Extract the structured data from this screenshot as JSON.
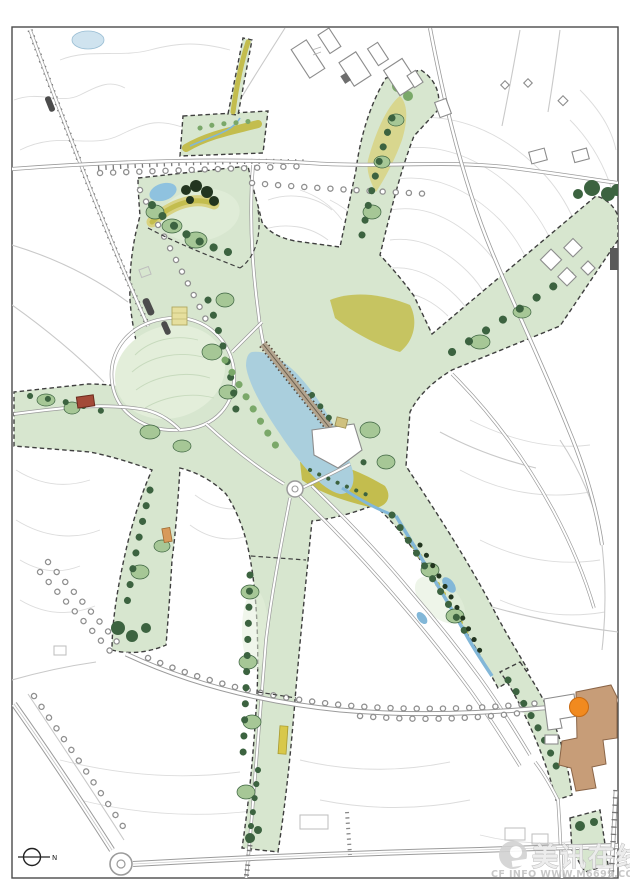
{
  "watermark": {
    "brand": "美讯在线",
    "url": "CF INFO WWW.M6699.COM"
  },
  "north_arrow": {
    "label": "N"
  },
  "palette": {
    "frame": "#4a4a4a",
    "contour": "#dcdcdc",
    "roadCasing": "#9b9b9b",
    "roadFaint": "#c9c9c9",
    "park": "#d7e6cf",
    "lawn": "#e3eeda",
    "canopy": "#a6c796",
    "treeMid": "#7aa869",
    "treeDark": "#3c6340",
    "treeDarkest": "#22351f",
    "meadow": "#c3bd4e",
    "meadowLight": "#d8d282",
    "lake": "#aacfdd",
    "pond": "#8fc2df",
    "stream": "#82b7d8",
    "bridgeDeck": "#b3a48e",
    "bridgeTick": "#55493b",
    "borderDash": "#3f3f3f",
    "bldgStroke": "#8c8c8c",
    "tan": "#c79d78",
    "tanStroke": "#8a6548",
    "red": "#a34a38",
    "orange": "#f18a1f",
    "khaki": "#cfc17f",
    "court": "#e6df9e"
  }
}
